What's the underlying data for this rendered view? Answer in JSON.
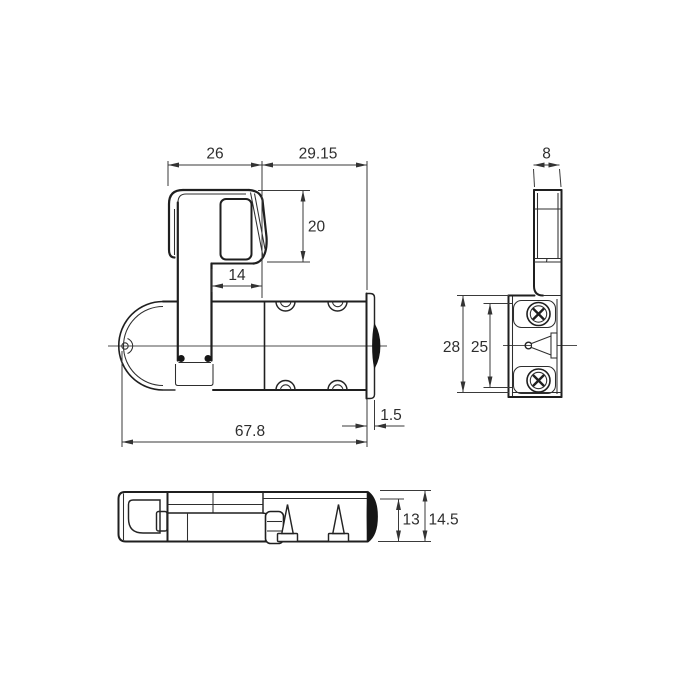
{
  "colors": {
    "background": "#ffffff",
    "object_lines": "#1f1f1f",
    "dimension_lines": "#3a3a3a",
    "text": "#2e2e2e"
  },
  "front_view": {
    "dims": {
      "hook_width": "26",
      "body_right_span": "29.15",
      "hook_height": "20",
      "hook_underside": "14",
      "overall_length": "67.8",
      "end_cap_thickness": "1.5"
    }
  },
  "side_view": {
    "dims": {
      "arm_thickness": "8",
      "block_height": "28",
      "pocket_height": "25"
    }
  },
  "bottom_view": {
    "dims": {
      "body_depth": "13",
      "overall_depth": "14.5"
    }
  }
}
